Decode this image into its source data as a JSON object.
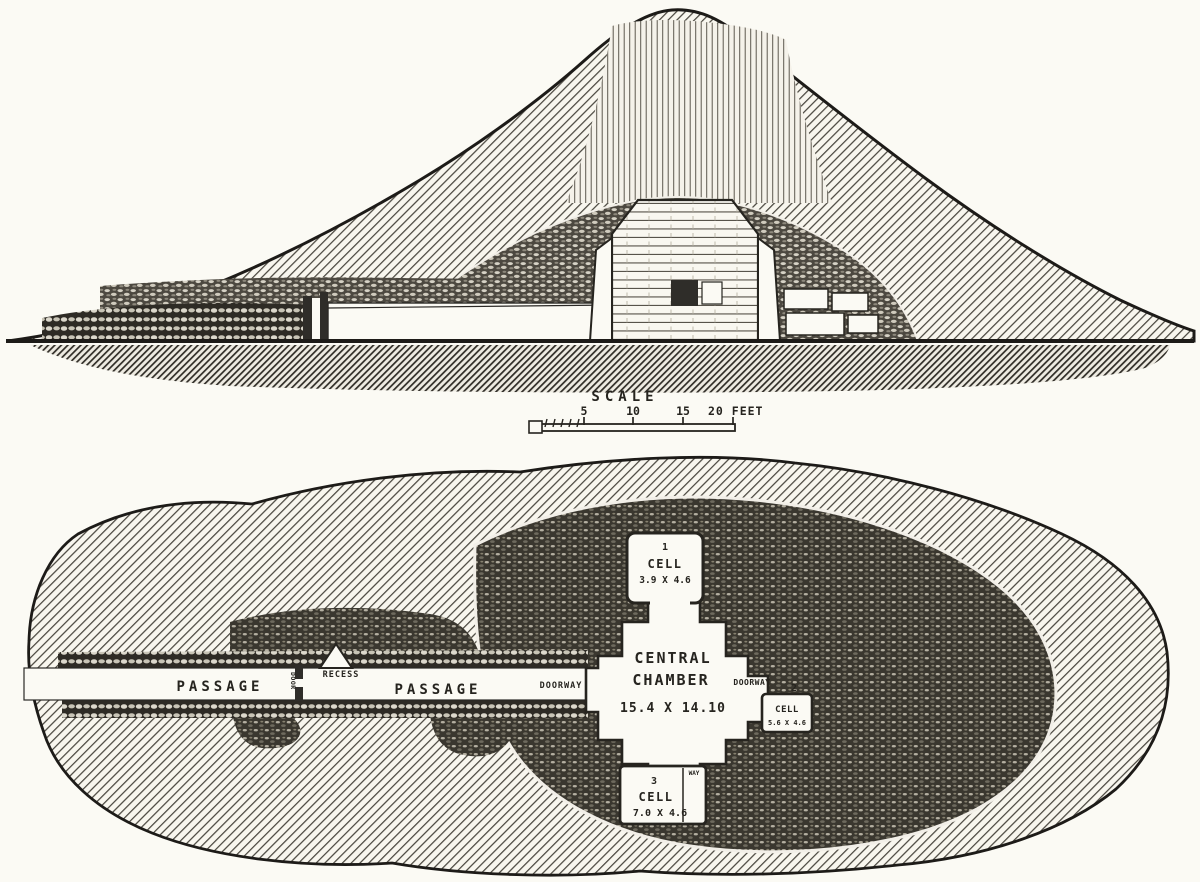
{
  "figure": {
    "ink": "#26241f",
    "paper": "#fbfaf4",
    "description": "Engraved section and plan of a chambered burial mound"
  },
  "scale_bar": {
    "title": "SCALE",
    "ticks": [
      "5",
      "10",
      "15"
    ],
    "end_label": "20 FEET"
  },
  "plan_view": {
    "passage_label_outer": "PASSAGE",
    "passage_label_inner": "PASSAGE",
    "recess_label": "RECESS",
    "door_label": "DOOR",
    "doorway_label_west": "DOORWAY",
    "doorway_label_east": "DOORWAY",
    "doorway_label_south": "WAY",
    "central_chamber": {
      "name_line1": "CENTRAL",
      "name_line2": "CHAMBER",
      "dimensions": "15.4 X 14.10"
    },
    "cells": [
      {
        "number": "1",
        "label": "CELL",
        "dimensions": "3.9 X 4.6"
      },
      {
        "number": "2",
        "label": "CELL",
        "dimensions": "5.6 X 4.6"
      },
      {
        "number": "3",
        "label": "CELL",
        "dimensions": "7.0 X 4.6"
      }
    ]
  }
}
